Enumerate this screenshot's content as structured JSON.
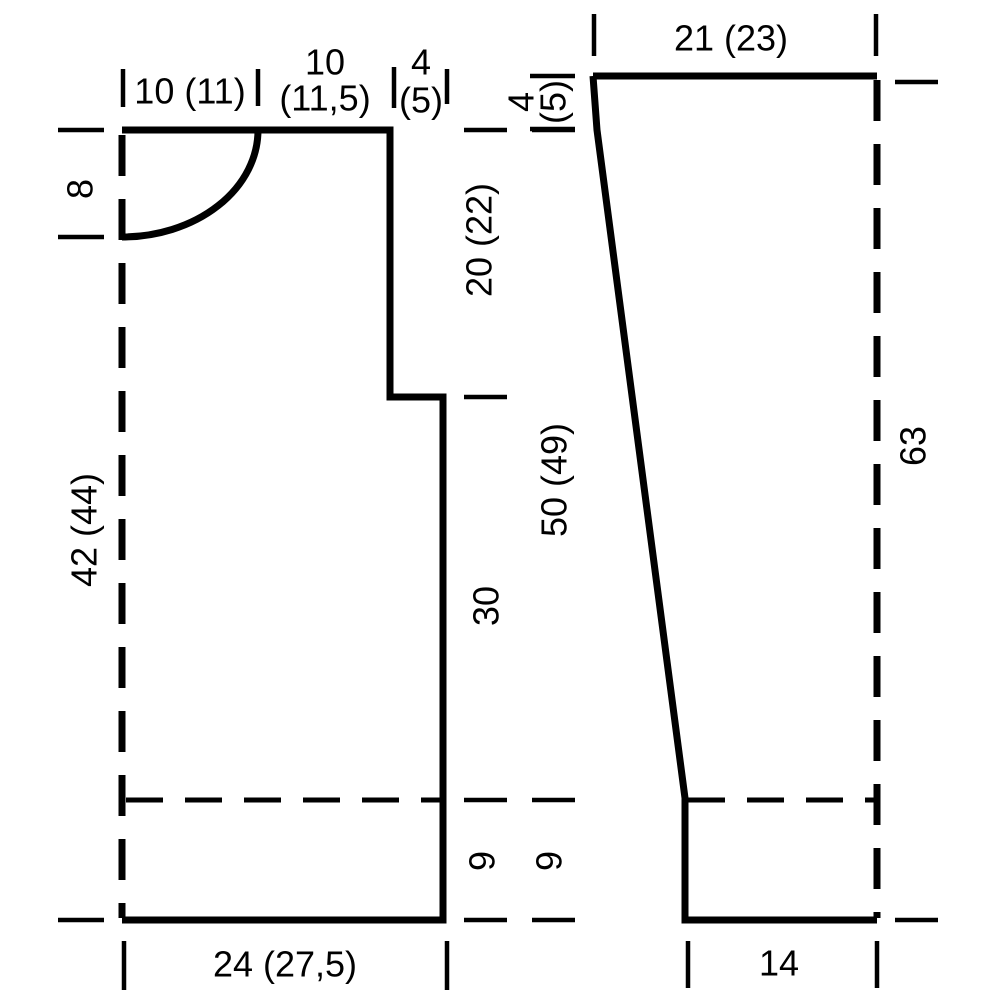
{
  "diagram": {
    "kind": "garment-pattern-schematic",
    "colors": {
      "line": "#000000",
      "background": "#ffffff"
    },
    "body_piece": {
      "shoulder_width": "10 (11)",
      "neck_width_line1": "10",
      "neck_width_line2": "(11,5)",
      "armhole_step_line1": "4",
      "armhole_step_line2": "(5)",
      "neck_depth": "8",
      "length": "42 (44)",
      "upper_section": "20 (22)",
      "middle_section": "30",
      "rib_height_inner": "9",
      "upper_length": "50 (49)",
      "rib_height_outer": "9",
      "bottom_width": "24 (27,5)"
    },
    "sleeve_piece": {
      "top_width": "21 (23)",
      "cap_step_line1": "4",
      "cap_step_line2": "(5)",
      "length": "63",
      "cuff_width": "14"
    }
  }
}
